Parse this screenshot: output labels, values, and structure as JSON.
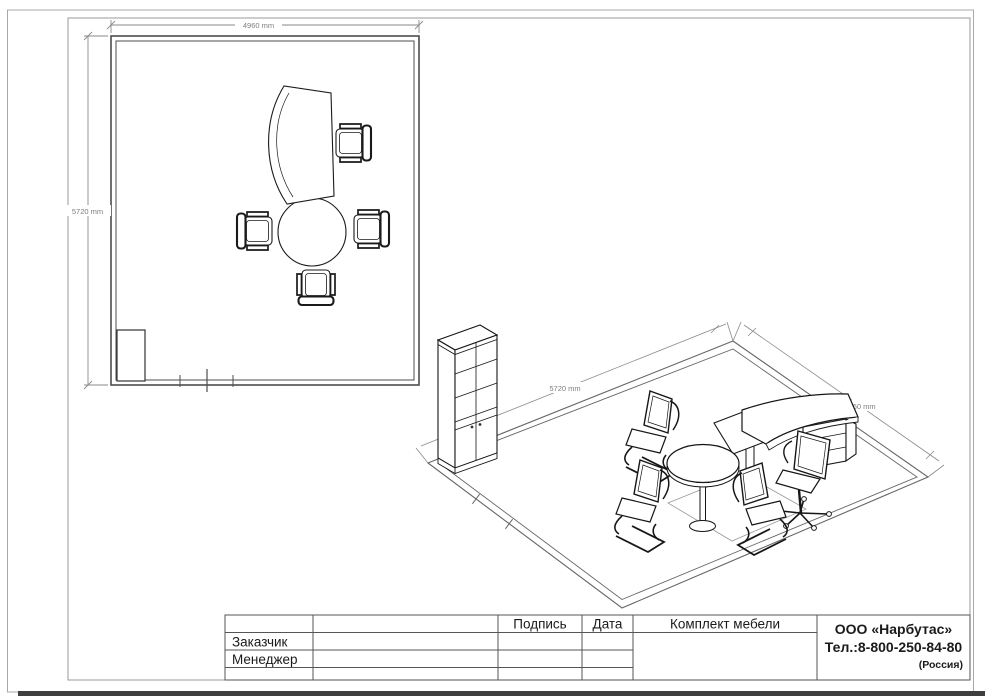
{
  "plan_view": {
    "width_dim": "4960 mm",
    "height_dim": "5720 mm"
  },
  "iso_view": {
    "left_dim": "5720 mm",
    "right_dim": "4960 mm"
  },
  "title_block": {
    "signature_label": "Подпись",
    "date_label": "Дата",
    "customer_label": "Заказчик",
    "manager_label": "Менеджер",
    "project_label": "Комплект мебели",
    "company_name": "ООО «Нарбутас»",
    "company_phone": "Тел.:8-800-250-84-80",
    "company_country": "(Россия)"
  },
  "colors": {
    "ink": "#1a1a1a",
    "wall": "#4d4d4d",
    "frame": "#9a9a9a",
    "dimension": "#8a8a8a",
    "page_edge": "#3f3f3f"
  }
}
